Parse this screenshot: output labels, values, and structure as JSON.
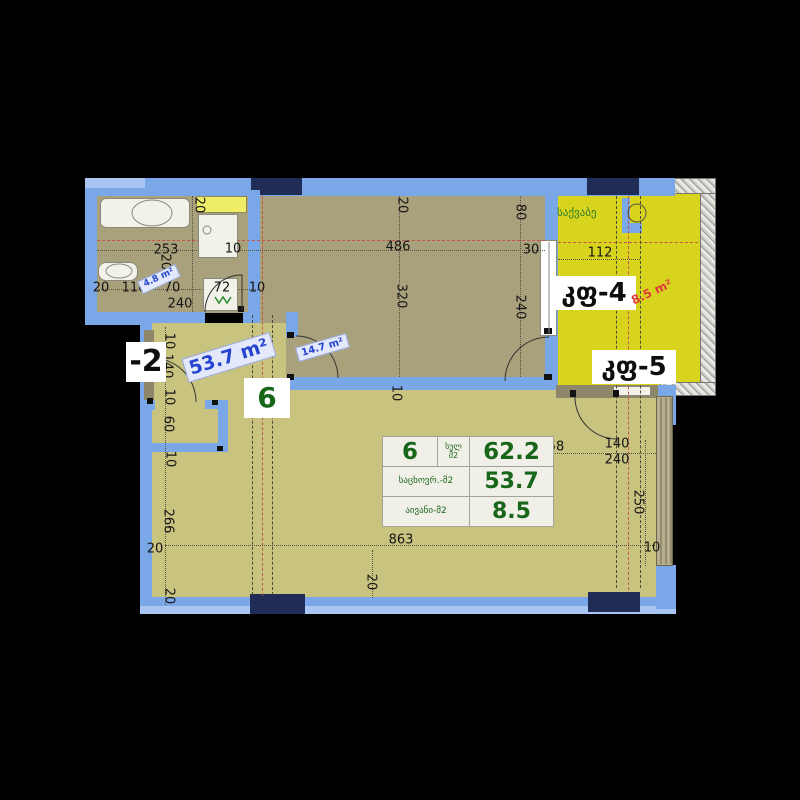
{
  "plan": {
    "unit_number": "6",
    "total_area_m2": "62.2",
    "living_area_m2": "53.7",
    "balcony_area_m2": "8.5"
  },
  "table": {
    "unit": "6",
    "total_label_line1": "სულ",
    "total_label_line2": "მ2",
    "total_value": "62.2",
    "living_label": "საცხოვრ.-მ2",
    "living_value": "53.7",
    "balcony_label": "აივანი-მ2",
    "balcony_value": "8.5"
  },
  "room_labels": {
    "corridor_unit": "6",
    "neighbor_unit_clipped": "-2",
    "window_door_4": "კფ-4",
    "window_door_5": "კფ-5",
    "boiler_room": "საქვაბე",
    "bathroom_area": "4.8 m²",
    "bedroom_area": "14.7 m²",
    "living_area": "53.7 m²",
    "balcony_area": "8.5 m²"
  },
  "dimensions": [
    "20",
    "253",
    "204",
    "10",
    "20",
    "110",
    "70",
    "240",
    "72",
    "10",
    "20",
    "486",
    "320",
    "80",
    "30",
    "240",
    "112",
    "10",
    "140",
    "10",
    "60",
    "10",
    "266",
    "20",
    "20",
    "10",
    "35",
    "863",
    "20",
    "58",
    "140",
    "240",
    "250",
    "10"
  ],
  "colors": {
    "wall_blue": "#7aa7e8",
    "wall_light_blue": "#a9c6f2",
    "column_navy": "#1f2c55",
    "floor_dark_olive": "#a9a17c",
    "floor_light_olive": "#c9c380",
    "balcony_yellow": "#d8d41e",
    "area_label_blue": "#2544cf",
    "balcony_label_red": "#e03b3b",
    "table_green": "#17661a"
  }
}
